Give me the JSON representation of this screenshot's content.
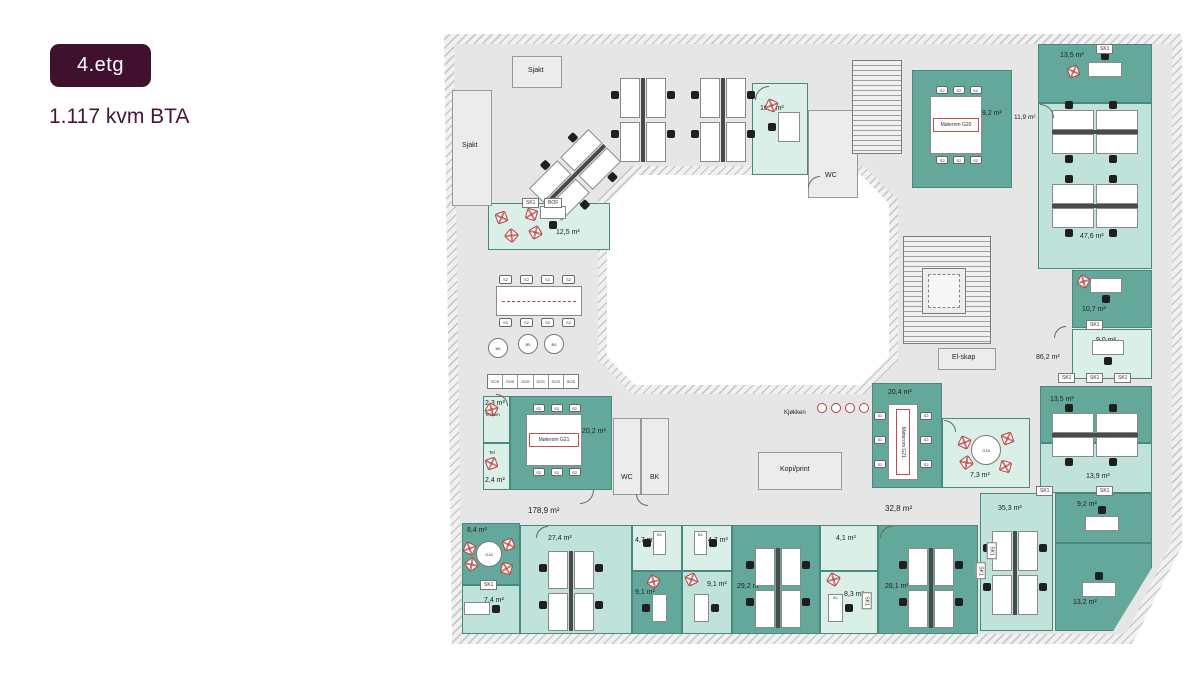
{
  "header": {
    "floor_badge": "4.etg",
    "area_text": "1.117 kvm BTA"
  },
  "colors": {
    "badge_bg": "#40102f",
    "room_dark": "#63a89b",
    "room_light": "#bfe2da",
    "room_mint": "#d9efe8",
    "accent_red": "#b5433d",
    "floor_gray": "#e6e6e6"
  },
  "plan": {
    "rooms": [
      {
        "name": "room-10-3",
        "label": "10,3 m²",
        "x": 312,
        "y": 57,
        "w": 56,
        "h": 92,
        "shade": "mint",
        "lx": 8,
        "ly": 22
      },
      {
        "name": "room-wc-top",
        "label": "WC",
        "x": 368,
        "y": 84,
        "w": 50,
        "h": 88,
        "shade": "gray",
        "lx": 17,
        "ly": 62
      },
      {
        "name": "room-moterom-g20",
        "label": "19,2 m²",
        "x": 472,
        "y": 44,
        "w": 100,
        "h": 118,
        "shade": "dark",
        "lx": 66,
        "ly": 40
      },
      {
        "name": "room-13-5-top",
        "label": "13,5 m²",
        "x": 598,
        "y": 18,
        "w": 114,
        "h": 59,
        "shade": "dark",
        "lx": 22,
        "ly": 8
      },
      {
        "name": "room-47-6",
        "label": "47,6 m²",
        "x": 598,
        "y": 77,
        "w": 114,
        "h": 166,
        "shade": "light",
        "lx": 42,
        "ly": 130
      },
      {
        "name": "room-10-7",
        "label": "10,7 m²",
        "x": 632,
        "y": 244,
        "w": 80,
        "h": 58,
        "shade": "dark",
        "lx": 10,
        "ly": 36
      },
      {
        "name": "room-9-0",
        "label": "9,0 m²",
        "x": 632,
        "y": 303,
        "w": 80,
        "h": 50,
        "shade": "mint",
        "lx": 24,
        "ly": 8
      },
      {
        "name": "room-13-5-mid",
        "label": "13,5 m²",
        "x": 600,
        "y": 360,
        "w": 112,
        "h": 57,
        "shade": "dark",
        "lx": 10,
        "ly": 10
      },
      {
        "name": "room-13-9",
        "label": "13,9 m²",
        "x": 600,
        "y": 417,
        "w": 112,
        "h": 50,
        "shade": "light",
        "lx": 46,
        "ly": 30
      },
      {
        "name": "room-9-2",
        "label": "9,2 m²",
        "x": 615,
        "y": 467,
        "w": 97,
        "h": 50,
        "shade": "dark",
        "lx": 22,
        "ly": 8
      },
      {
        "name": "room-13-2",
        "label": "13,2 m²",
        "x": 615,
        "y": 517,
        "w": 97,
        "h": 88,
        "shade": "dark",
        "bevel": true,
        "lx": 18,
        "ly": 56
      },
      {
        "name": "room-35-3",
        "label": "35,3 m²",
        "x": 540,
        "y": 467,
        "w": 73,
        "h": 138,
        "shade": "light",
        "lx": 18,
        "ly": 12
      },
      {
        "name": "room-8-4",
        "label": "8,4 m²",
        "x": 22,
        "y": 497,
        "w": 58,
        "h": 62,
        "shade": "dark",
        "lx": 5,
        "ly": 4
      },
      {
        "name": "room-7-4",
        "label": "7,4 m²",
        "x": 22,
        "y": 559,
        "w": 58,
        "h": 49,
        "shade": "light",
        "lx": 22,
        "ly": 12
      },
      {
        "name": "room-27-4",
        "label": "27,4 m²",
        "x": 80,
        "y": 499,
        "w": 112,
        "h": 109,
        "shade": "light",
        "lx": 28,
        "ly": 10
      },
      {
        "name": "room-4-7-a",
        "label": "4,7 m²",
        "x": 192,
        "y": 499,
        "w": 50,
        "h": 46,
        "shade": "mint",
        "lx": 3,
        "ly": 12
      },
      {
        "name": "room-4-7-b",
        "label": "4,7 m²",
        "x": 242,
        "y": 499,
        "w": 50,
        "h": 46,
        "shade": "mint",
        "lx": 26,
        "ly": 12
      },
      {
        "name": "room-9-1-a",
        "label": "9,1 m²",
        "x": 192,
        "y": 545,
        "w": 50,
        "h": 63,
        "shade": "dark",
        "lx": 3,
        "ly": 18
      },
      {
        "name": "room-9-1-b",
        "label": "9,1 m²",
        "x": 242,
        "y": 545,
        "w": 50,
        "h": 63,
        "shade": "light",
        "lx": 25,
        "ly": 10
      },
      {
        "name": "room-29-2",
        "label": "29,2 m²",
        "x": 292,
        "y": 499,
        "w": 88,
        "h": 109,
        "shade": "dark",
        "lx": 5,
        "ly": 58
      },
      {
        "name": "room-4-1",
        "label": "4,1 m²",
        "x": 380,
        "y": 499,
        "w": 58,
        "h": 46,
        "shade": "mint",
        "lx": 16,
        "ly": 10
      },
      {
        "name": "room-8-3",
        "label": "8,3 m²",
        "x": 380,
        "y": 545,
        "w": 58,
        "h": 63,
        "shade": "mint",
        "lx": 24,
        "ly": 20
      },
      {
        "name": "room-28-1",
        "label": "28,1 m²",
        "x": 438,
        "y": 499,
        "w": 100,
        "h": 109,
        "shade": "dark",
        "lx": 7,
        "ly": 58
      },
      {
        "name": "room-12-5",
        "label": "12,5 m²",
        "x": 48,
        "y": 177,
        "w": 122,
        "h": 47,
        "shade": "mint",
        "lx": 68,
        "ly": 26
      },
      {
        "name": "room-tel-rom",
        "label": "2,3 m²",
        "x": 43,
        "y": 370,
        "w": 27,
        "h": 47,
        "shade": "mint",
        "lx": 2,
        "ly": 4
      },
      {
        "name": "room-tel",
        "label": "2,4 m²",
        "x": 43,
        "y": 417,
        "w": 27,
        "h": 47,
        "shade": "mint",
        "lx": 2,
        "ly": 34
      },
      {
        "name": "room-moterom-g21",
        "label": "20,2 m²",
        "x": 70,
        "y": 370,
        "w": 102,
        "h": 94,
        "shade": "dark",
        "lx": 72,
        "ly": 32
      },
      {
        "name": "room-wc-mid",
        "label": "WC",
        "x": 173,
        "y": 392,
        "w": 28,
        "h": 77,
        "shade": "gray",
        "lx": 8,
        "ly": 56
      },
      {
        "name": "room-bk",
        "label": "BK",
        "x": 201,
        "y": 392,
        "w": 28,
        "h": 77,
        "shade": "gray",
        "lx": 9,
        "ly": 56
      },
      {
        "name": "room-moterom-g21-b",
        "label": "20,4 m²",
        "x": 432,
        "y": 357,
        "w": 70,
        "h": 105,
        "shade": "dark",
        "lx": 16,
        "ly": 6
      },
      {
        "name": "room-7-3",
        "label": "7,3 m²",
        "x": 502,
        "y": 392,
        "w": 88,
        "h": 70,
        "shade": "mint",
        "lx": 28,
        "ly": 54
      },
      {
        "name": "room-sjakt-a",
        "label": "Sjakt",
        "x": 72,
        "y": 30,
        "w": 50,
        "h": 32,
        "shade": "gray",
        "lx": 16,
        "ly": 11
      },
      {
        "name": "room-sjakt-b",
        "label": "Sjakt",
        "x": 12,
        "y": 64,
        "w": 40,
        "h": 116,
        "shade": "gray",
        "lx": 10,
        "ly": 52
      },
      {
        "name": "room-el-skap",
        "label": "El-skap",
        "x": 498,
        "y": 322,
        "w": 58,
        "h": 22,
        "shade": "gray",
        "lx": 14,
        "ly": 6
      },
      {
        "name": "room-kopi-print",
        "label": "Kopi/print",
        "x": 318,
        "y": 426,
        "w": 84,
        "h": 38,
        "shade": "gray",
        "lx": 22,
        "ly": 14
      }
    ],
    "labels": [
      {
        "text": "178,9 m²",
        "x": 88,
        "y": 480,
        "size": 8
      },
      {
        "text": "32,8 m²",
        "x": 445,
        "y": 478,
        "size": 8
      },
      {
        "text": "86,2 m²",
        "x": 596,
        "y": 328,
        "size": 7
      },
      {
        "text": "11,9 m²",
        "x": 574,
        "y": 88,
        "size": 6.5
      },
      {
        "text": "Kjøkken",
        "x": 344,
        "y": 384,
        "size": 6
      },
      {
        "text": "Tel rom",
        "x": 45,
        "y": 386,
        "size": 4.5
      },
      {
        "text": "Tel",
        "x": 49,
        "y": 424,
        "size": 4.5
      }
    ],
    "sk1_labels": [
      {
        "text": "SK1",
        "x": 82,
        "y": 172
      },
      {
        "text": "BOF",
        "x": 104,
        "y": 172
      },
      {
        "text": "SK1",
        "x": 656,
        "y": 18
      },
      {
        "text": "SK1",
        "x": 646,
        "y": 294
      },
      {
        "text": "SK1",
        "x": 618,
        "y": 347
      },
      {
        "text": "SK1",
        "x": 646,
        "y": 347
      },
      {
        "text": "SK1",
        "x": 674,
        "y": 347
      },
      {
        "text": "SK1",
        "x": 596,
        "y": 460
      },
      {
        "text": "SK1",
        "x": 656,
        "y": 460
      },
      {
        "text": "SK1",
        "x": 40,
        "y": 554
      },
      {
        "text": "SK1",
        "x": 543,
        "y": 520,
        "rot": 90
      },
      {
        "text": "SK1",
        "x": 418,
        "y": 570,
        "rot": 90
      },
      {
        "text": "SK1",
        "x": 532,
        "y": 540,
        "rot": 90
      }
    ],
    "clusters": [
      {
        "name": "desk-cluster",
        "x": 180,
        "y": 52
      },
      {
        "name": "desk-cluster",
        "x": 260,
        "y": 52
      },
      {
        "name": "desk-cluster",
        "x": 112,
        "y": 107,
        "rot": 45
      },
      {
        "name": "desk-cluster",
        "x": 612,
        "y": 84,
        "horizontal": true
      },
      {
        "name": "desk-cluster",
        "x": 612,
        "y": 158,
        "horizontal": true
      },
      {
        "name": "desk-cluster",
        "x": 612,
        "y": 387,
        "horizontal": true
      },
      {
        "name": "desk-cluster",
        "x": 552,
        "y": 505
      },
      {
        "name": "desk-cluster",
        "x": 108,
        "y": 525,
        "h": 80
      },
      {
        "name": "desk-cluster",
        "x": 315,
        "y": 522,
        "h": 80
      },
      {
        "name": "desk-cluster",
        "x": 468,
        "y": 522,
        "h": 80
      }
    ],
    "desks": [
      {
        "x": 338,
        "y": 86,
        "w": 22,
        "h": 30,
        "chair": "left"
      },
      {
        "x": 648,
        "y": 36,
        "w": 34,
        "h": 15,
        "chair": "top"
      },
      {
        "x": 650,
        "y": 252,
        "w": 32,
        "h": 15,
        "chair": "bottom"
      },
      {
        "x": 652,
        "y": 314,
        "w": 32,
        "h": 15,
        "chair": "bottom"
      },
      {
        "x": 645,
        "y": 490,
        "w": 34,
        "h": 15,
        "chair": "top"
      },
      {
        "x": 642,
        "y": 556,
        "w": 34,
        "h": 15,
        "chair": "top"
      },
      {
        "x": 24,
        "y": 576,
        "w": 26,
        "h": 13,
        "chair": "right"
      },
      {
        "x": 212,
        "y": 568,
        "w": 15,
        "h": 28,
        "chair": "left"
      },
      {
        "x": 254,
        "y": 568,
        "w": 15,
        "h": 28,
        "chair": "right"
      },
      {
        "x": 388,
        "y": 568,
        "w": 15,
        "h": 28,
        "chair": "right",
        "label": "B1"
      },
      {
        "x": 213,
        "y": 505,
        "w": 13,
        "h": 24,
        "chair": "left",
        "label": "B1"
      },
      {
        "x": 254,
        "y": 505,
        "w": 13,
        "h": 24,
        "chair": "right",
        "label": "B1"
      },
      {
        "x": 100,
        "y": 180,
        "w": 26,
        "h": 13,
        "chair": "bottom"
      }
    ],
    "conf_tables": [
      {
        "name": "meeting-table-g20",
        "x": 490,
        "y": 70,
        "w": 52,
        "h": 58,
        "code": "Møterom",
        "num": "G20",
        "orient": "h",
        "chair_label": "S2"
      },
      {
        "name": "meeting-table-g21",
        "x": 86,
        "y": 388,
        "w": 56,
        "h": 52,
        "code": "Møterom",
        "num": "G21",
        "orient": "h",
        "chair_label": "S2"
      },
      {
        "name": "meeting-table-g21-b",
        "x": 448,
        "y": 378,
        "w": 30,
        "h": 76,
        "code": "Møterom",
        "num": "G21",
        "orient": "v",
        "chair_label": "S2"
      }
    ],
    "round_tables": [
      {
        "name": "round-table-g16",
        "cx": 49,
        "cy": 528,
        "r": 13,
        "code": "G16"
      },
      {
        "name": "round-table-g15",
        "cx": 546,
        "cy": 424,
        "r": 15,
        "code": "G15"
      }
    ],
    "red_chairs": [
      {
        "x": 326,
        "y": 74,
        "rot": 25
      },
      {
        "x": 628,
        "y": 40,
        "rot": -20
      },
      {
        "x": 638,
        "y": 250,
        "rot": 30
      },
      {
        "x": 208,
        "y": 550,
        "rot": 30
      },
      {
        "x": 246,
        "y": 548,
        "rot": -25
      },
      {
        "x": 388,
        "y": 548,
        "rot": 30
      },
      {
        "x": 56,
        "y": 186,
        "rot": -20
      },
      {
        "x": 86,
        "y": 183,
        "rot": 15
      },
      {
        "x": 66,
        "y": 204,
        "rot": 40
      },
      {
        "x": 90,
        "y": 201,
        "rot": -30
      },
      {
        "x": 46,
        "y": 378,
        "rot": 30
      },
      {
        "x": 46,
        "y": 432,
        "rot": -20
      }
    ],
    "stools": [
      {
        "cx": 382,
        "cy": 382
      },
      {
        "cx": 396,
        "cy": 382
      },
      {
        "cx": 410,
        "cy": 382
      },
      {
        "cx": 424,
        "cy": 382
      }
    ],
    "lounge_chairs": [
      {
        "cx": 58,
        "cy": 322,
        "r": 10,
        "label": "B5"
      },
      {
        "cx": 88,
        "cy": 318,
        "r": 10,
        "label": "B5"
      },
      {
        "cx": 114,
        "cy": 318,
        "r": 10,
        "label": "B5"
      }
    ],
    "sofa": {
      "x": 47,
      "y": 348,
      "w": 92,
      "h": 15,
      "segments": 6,
      "label": "SOS"
    },
    "long_table": {
      "x": 56,
      "y": 260,
      "w": 86,
      "h": 30,
      "chairs_per_side": 4,
      "chair_label": "S2"
    },
    "stairs": [
      {
        "name": "main-stairs",
        "x": 463,
        "y": 210,
        "w": 88,
        "h": 108
      },
      {
        "name": "top-stairs",
        "x": 412,
        "y": 34,
        "w": 50,
        "h": 94
      }
    ],
    "elevator": {
      "x": 482,
      "y": 242,
      "w": 44,
      "h": 46
    },
    "doors": [
      {
        "x": 315,
        "y": 60,
        "r": 14,
        "rot": 0
      },
      {
        "x": 56,
        "y": 368,
        "r": 12,
        "rot": 90
      },
      {
        "x": 140,
        "y": 464,
        "r": 14,
        "rot": 180
      },
      {
        "x": 600,
        "y": 78,
        "r": 14,
        "rot": 90
      },
      {
        "x": 614,
        "y": 300,
        "r": 12,
        "rot": 0
      },
      {
        "x": 96,
        "y": 500,
        "r": 12,
        "rot": 0
      },
      {
        "x": 440,
        "y": 500,
        "r": 12,
        "rot": 0
      },
      {
        "x": 504,
        "y": 394,
        "r": 12,
        "rot": 90
      },
      {
        "x": 368,
        "y": 150,
        "r": 12,
        "rot": 0
      },
      {
        "x": 196,
        "y": 468,
        "r": 12,
        "rot": 270
      }
    ]
  }
}
